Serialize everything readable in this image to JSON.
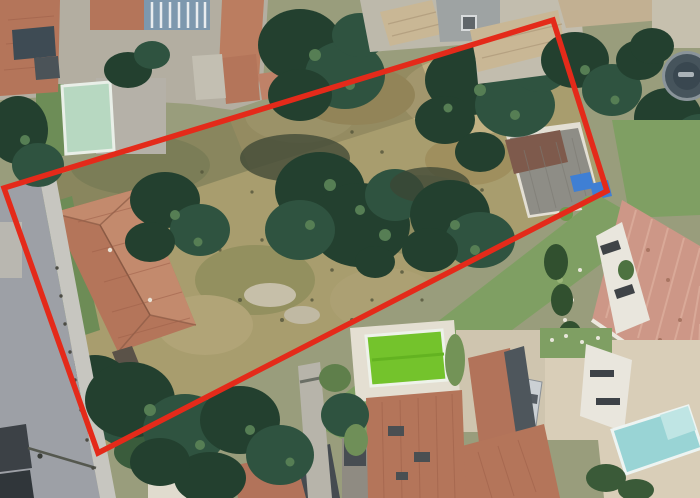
{
  "image": {
    "kind": "aerial-satellite-photograph",
    "description": "Top-down aerial view of a suburban residential block. A vacant plot of dry grass with scattered dark trees and one large terracotta-roof house is outlined by a red boundary polygon. A road runs along the left edge; neighbouring houses with terracotta, tan and salmon roofs surround the plot; three swimming pools (pale green top-left, bright green bottom-centre, turquoise bottom-right) and one round above-ground pool (top-right) are visible.",
    "width_px": 700,
    "height_px": 498,
    "visible_text": ""
  },
  "boundary_overlay": {
    "shape": "quadrilateral",
    "points": "4,188 553,20 607,191 98,453",
    "color": "#e42a1a",
    "stroke_width": 5.5,
    "meaning": "property / plot boundary"
  },
  "colors": {
    "field_base": "#a89d6e",
    "road_asphalt": "#9da0a6",
    "sidewalk": "#c7c6c0",
    "roof_terracotta": "#b4755a",
    "roof_salmon": "#cd9787",
    "roof_tan": "#c9b795",
    "roof_gray": "#8e8d86",
    "tree_dark_green": "#23402f",
    "lawn_green": "#7f9f63",
    "pool_pale_green": "#b7d8c1",
    "pool_green_bright": "#74c32c",
    "pool_turquoise": "#99d4d5",
    "pool_round_cover": "#46545c",
    "solar_panel_blue": "#3f7fd4"
  },
  "scene": {
    "plot": {
      "ground": "dry tan-olive grass with bare patches",
      "contains": [
        "large terracotta hip-roof house (west side)",
        "several dark green tree clusters",
        "small gray-roof outbuilding with blue panels (east corner)"
      ]
    },
    "features": [
      {
        "name": "road",
        "position": "left edge, runs vertically"
      },
      {
        "name": "sidewalk-with-bollards",
        "position": "right side of road"
      },
      {
        "name": "pale-green-pool",
        "position": "top-left garden"
      },
      {
        "name": "blue-pergola-lap-pool",
        "position": "top edge"
      },
      {
        "name": "round-above-ground-pool",
        "position": "top-right corner"
      },
      {
        "name": "bright-green-pool",
        "position": "bottom-centre garden"
      },
      {
        "name": "turquoise-pool",
        "position": "bottom-right garden"
      },
      {
        "name": "large-salmon-ribbed-roof",
        "position": "right side"
      },
      {
        "name": "parked-silver-car",
        "position": "bottom-right driveway"
      },
      {
        "name": "footpath",
        "position": "bottom-centre between gardens"
      }
    ]
  }
}
